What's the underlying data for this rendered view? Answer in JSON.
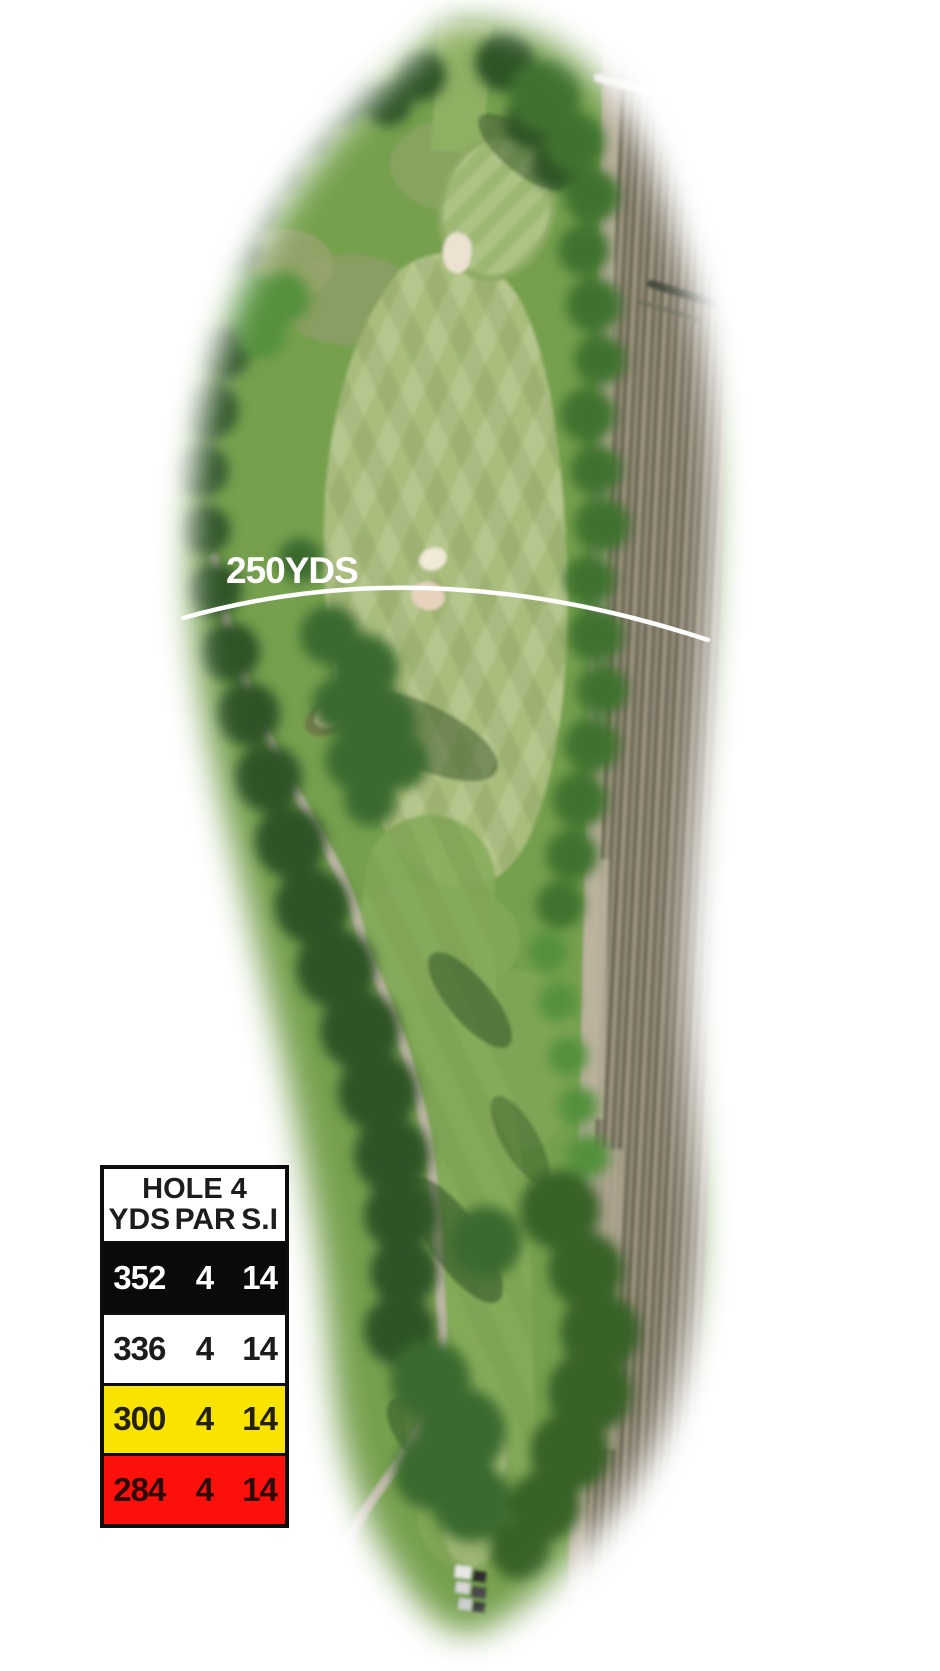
{
  "map": {
    "marker_label": "250YDS"
  },
  "colors": {
    "background": "#ffffff",
    "marker_line": "#ffffff",
    "marker_text": "#ffffff"
  },
  "scorecard": {
    "title": "HOLE 4",
    "columns": [
      "YDS",
      "PAR",
      "S.I"
    ],
    "rows": [
      {
        "tee": "black",
        "yds": "352",
        "par": "4",
        "si": "14",
        "bg": "#0a0a0a",
        "fg": "#ffffff"
      },
      {
        "tee": "white",
        "yds": "336",
        "par": "4",
        "si": "14",
        "bg": "#ffffff",
        "fg": "#1c1c1c"
      },
      {
        "tee": "yellow",
        "yds": "300",
        "par": "4",
        "si": "14",
        "bg": "#f8e400",
        "fg": "#25200a"
      },
      {
        "tee": "red",
        "yds": "284",
        "par": "4",
        "si": "14",
        "bg": "#fb100b",
        "fg": "#2b0a05"
      }
    ]
  }
}
